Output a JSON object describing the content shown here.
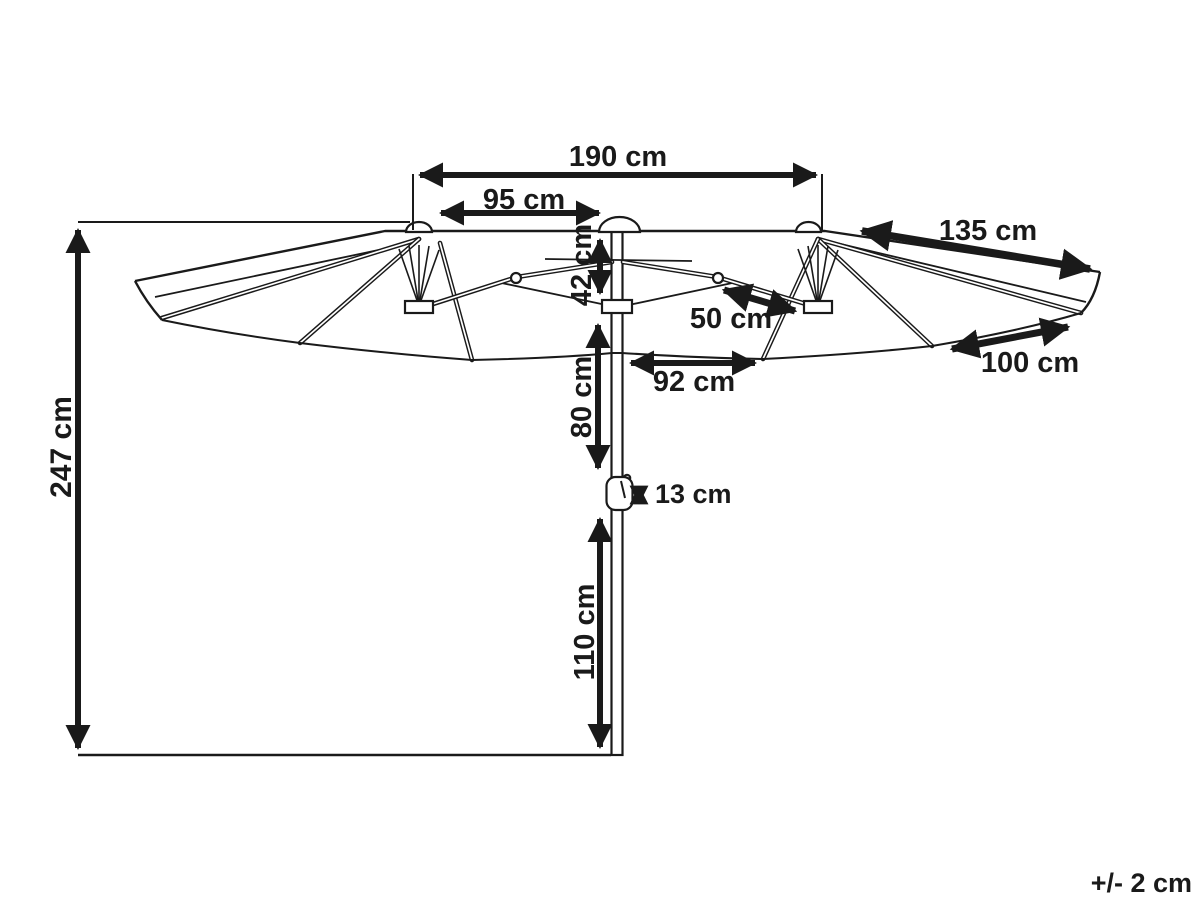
{
  "diagram": {
    "kind": "product-dimension-diagram",
    "subject": "double-canopy parasol side view with pole and crank",
    "line_color": "#1a1a1a",
    "background_color": "#ffffff"
  },
  "dimensions": {
    "total_width": "190 cm",
    "half_width": "95 cm",
    "canopy_drop": "42 cm",
    "canopy_edge_right": "135 cm",
    "strut": "50 cm",
    "outer_edge_right": "100 cm",
    "under_canopy_width": "92 cm",
    "pole_upper": "80 cm",
    "crank": "13 cm",
    "pole_lower": "110 cm",
    "total_height": "247 cm",
    "tolerance": "+/- 2 cm"
  }
}
